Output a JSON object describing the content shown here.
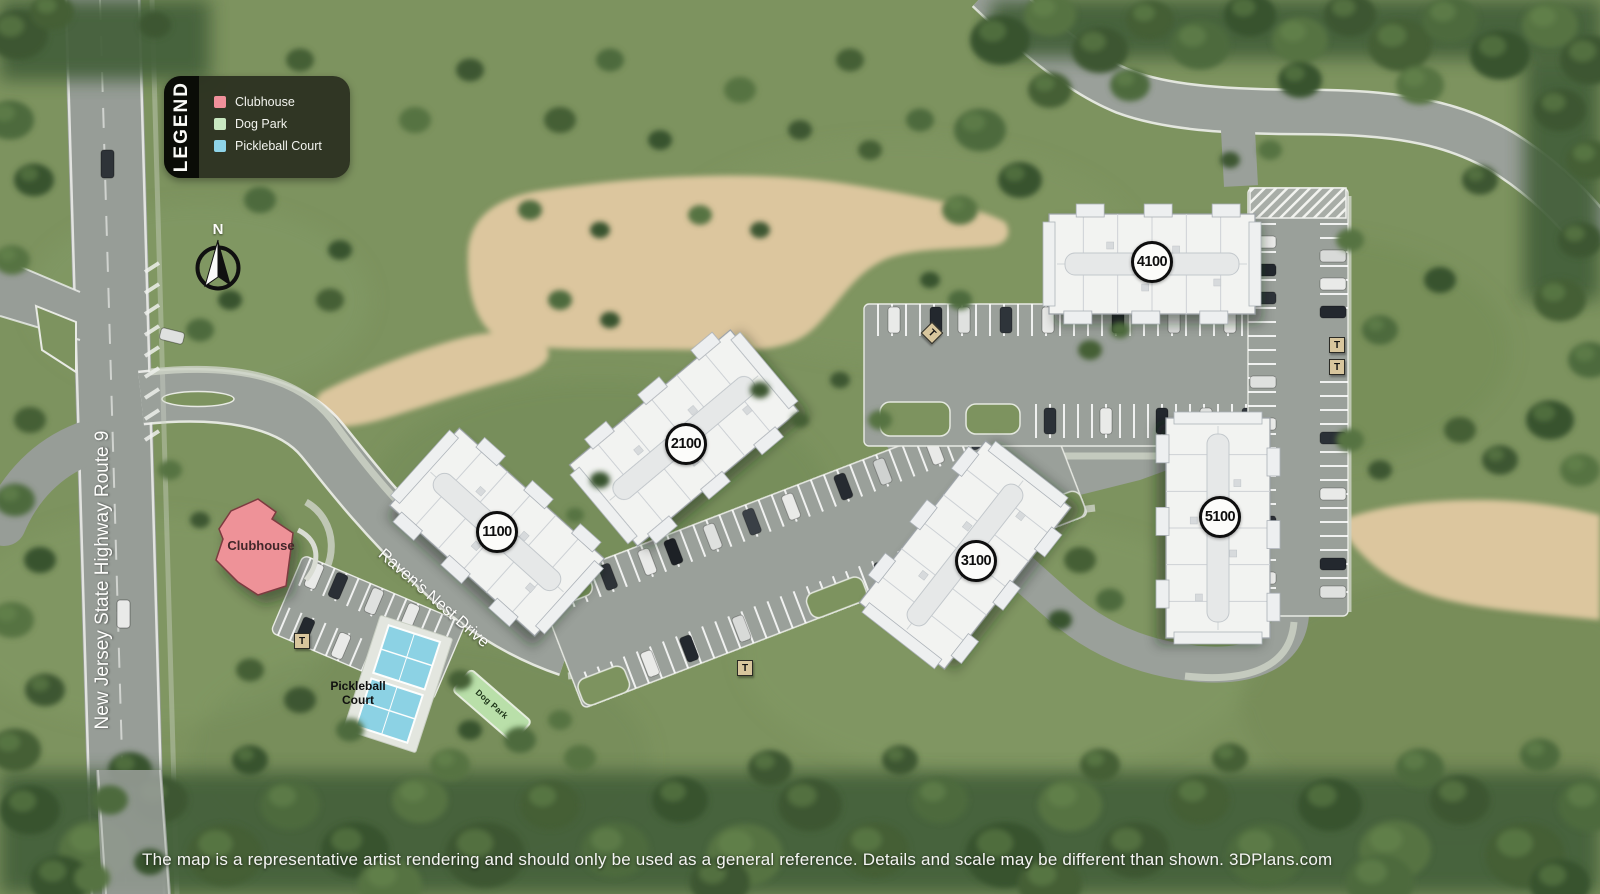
{
  "legend": {
    "title": "LEGEND",
    "items": [
      {
        "label": "Clubhouse",
        "color": "#f0909a"
      },
      {
        "label": "Dog Park",
        "color": "#c8e8c0"
      },
      {
        "label": "Pickleball Court",
        "color": "#8ed4e8"
      }
    ]
  },
  "compass": {
    "north_label": "N"
  },
  "road_labels": {
    "highway": "New Jersey State Highway Route 9",
    "drive": "Raven's Nest Drive"
  },
  "buildings": [
    {
      "label": "1100"
    },
    {
      "label": "2100"
    },
    {
      "label": "3100"
    },
    {
      "label": "4100"
    },
    {
      "label": "5100"
    }
  ],
  "amenities": {
    "clubhouse": "Clubhouse",
    "pickleball_court": "Pickleball Court",
    "dog_park": "Dog Park"
  },
  "markers": {
    "transformer_label": "T"
  },
  "colors": {
    "grass": "#7d935f",
    "road": "#9aa09a",
    "dirt": "#dcc69e",
    "building": "#f2f3f1",
    "clubhouse": "#ee9298",
    "pickleball": "#8cd2e4",
    "dog_park": "#b9dfa9"
  },
  "footer": {
    "disclaimer": "The map is a representative artist rendering and should only be used as a general reference. Details and scale may be different than shown.",
    "brand": "3DPlans.com"
  }
}
